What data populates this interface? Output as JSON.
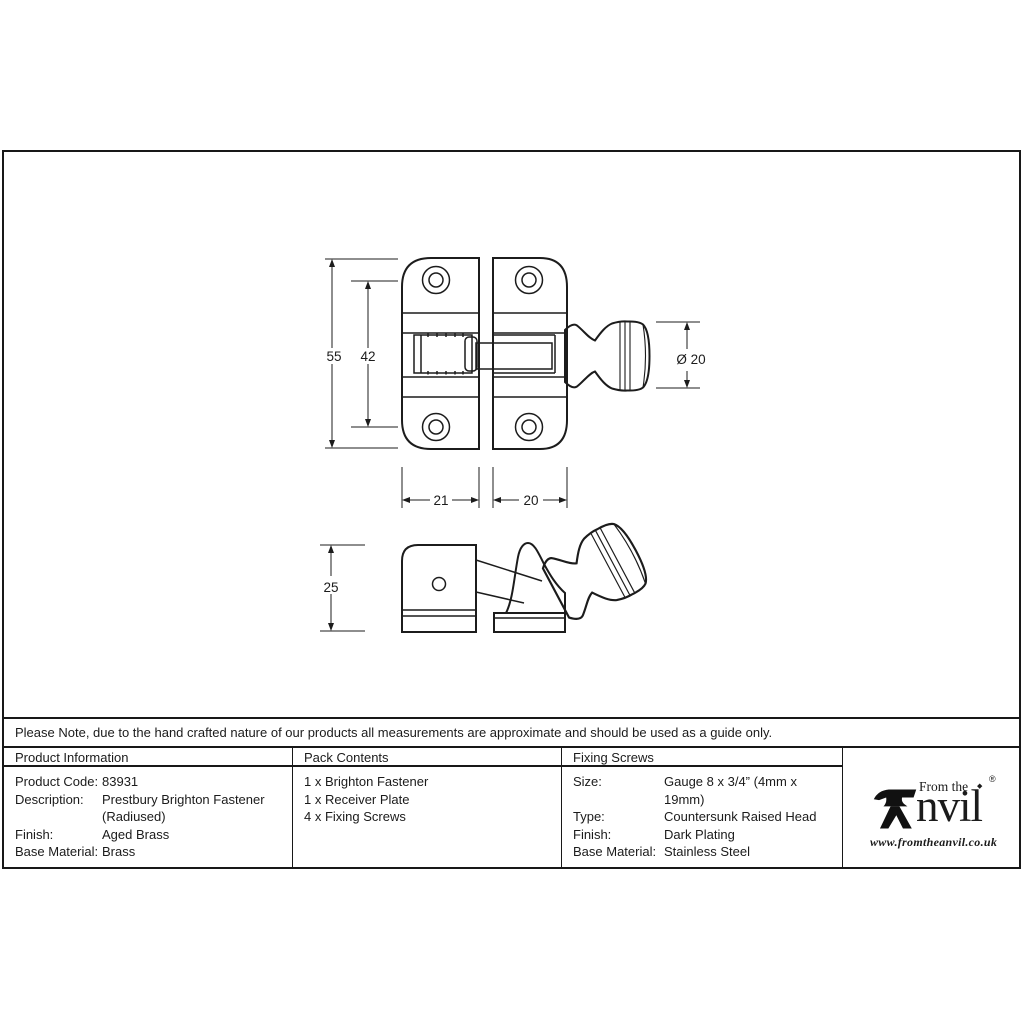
{
  "note": "Please Note, due to the hand crafted nature of our products all measurements are approximate and should be used as a guide only.",
  "drawing": {
    "dimensions": {
      "plate_height": "55",
      "hole_spacing": "42",
      "knob_diameter": "Ø 20",
      "left_plate_width": "21",
      "right_plate_width": "20",
      "side_height": "25"
    }
  },
  "table": {
    "product_info": {
      "header": "Product Information",
      "rows": [
        {
          "label": "Product Code:",
          "value": "83931"
        },
        {
          "label": "Description:",
          "value": "Prestbury Brighton Fastener"
        },
        {
          "label": "",
          "value": "(Radiused)"
        },
        {
          "label": "Finish:",
          "value": "Aged Brass"
        },
        {
          "label": "Base Material:",
          "value": "Brass"
        }
      ]
    },
    "pack_contents": {
      "header": "Pack Contents",
      "items": [
        "1 x Brighton Fastener",
        "1 x Receiver Plate",
        "4 x Fixing Screws"
      ]
    },
    "fixing_screws": {
      "header": "Fixing Screws",
      "rows": [
        {
          "label": "Size:",
          "value": "Gauge 8 x 3/4” (4mm x 19mm)"
        },
        {
          "label": "Type:",
          "value": "Countersunk Raised Head"
        },
        {
          "label": "Finish:",
          "value": "Dark Plating"
        },
        {
          "label": "Base Material:",
          "value": "Stainless Steel"
        }
      ]
    }
  },
  "logo": {
    "from_the": "From the",
    "brand_suffix": "nvil",
    "diamond": "◆",
    "registered": "®",
    "website": "www.fromtheanvil.co.uk"
  }
}
